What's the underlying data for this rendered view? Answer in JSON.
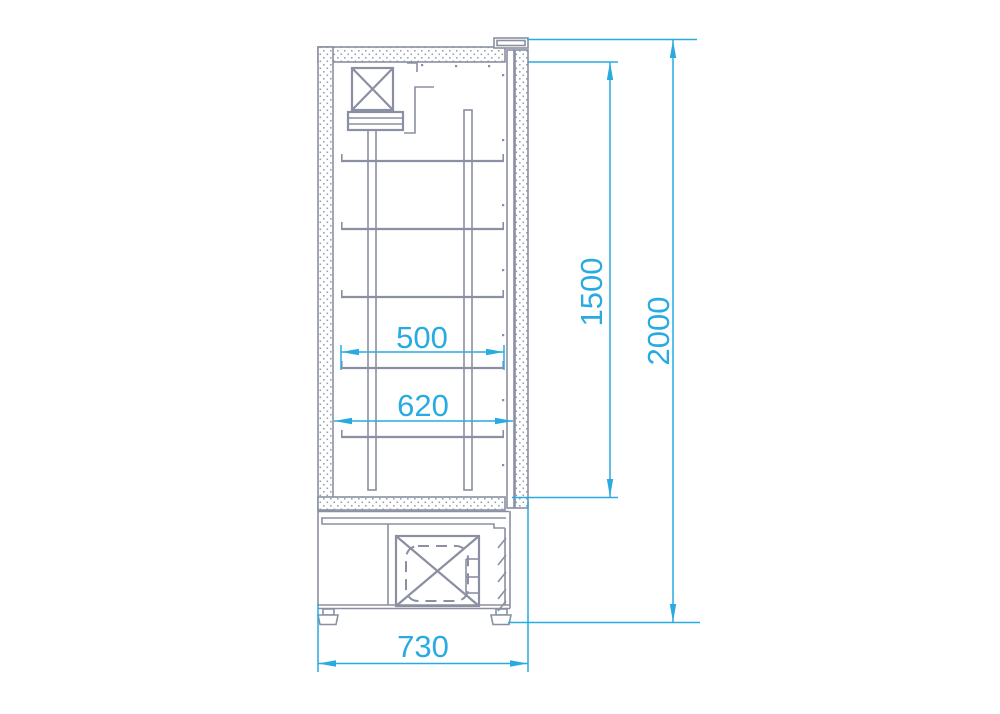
{
  "drawing": {
    "dimensions": {
      "shelf_width": "500",
      "interior_depth": "620",
      "door_height": "1500",
      "overall_height": "2000",
      "overall_depth": "730"
    }
  },
  "colors": {
    "dimension_accent": "#29abe2",
    "drawing_line": "#8a90a1",
    "hatch_dot": "#9aa2b2",
    "background": "#ffffff"
  }
}
